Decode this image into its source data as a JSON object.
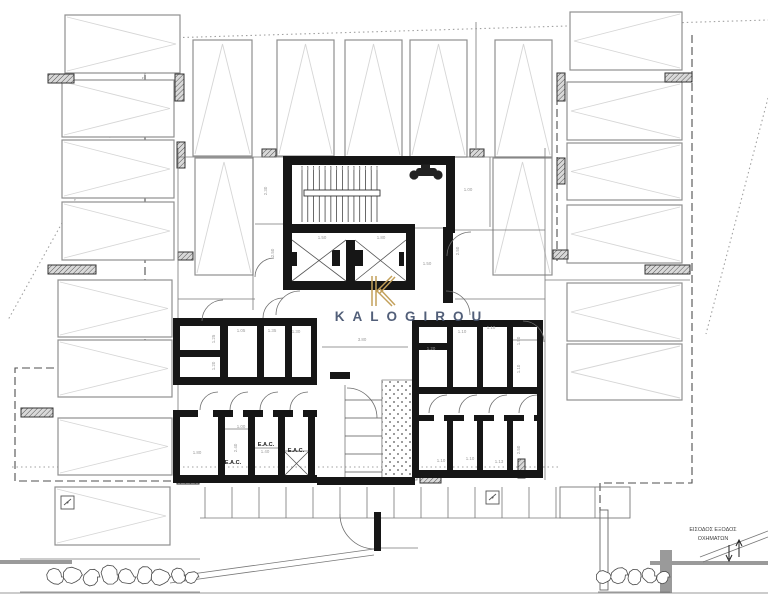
{
  "watermark": {
    "logo": "K",
    "brand": "KALOGIROU",
    "gold": "#c3a05a",
    "navy": "#44526e"
  },
  "entrance_note": {
    "line1": "ΕΙΣΟΔΟΣ ΕΞΟΔΟΣ",
    "line2": "ΟΧΗΜΑΤΩΝ"
  },
  "eac_labels": [
    {
      "text": "E.A.C.",
      "x": 266,
      "y": 446
    },
    {
      "text": "E.A.C.",
      "x": 296,
      "y": 452
    },
    {
      "text": "E.A.C.",
      "x": 233,
      "y": 464
    }
  ],
  "dimensions": [
    {
      "t": "3.80",
      "x": 362,
      "y": 341,
      "r": 0
    },
    {
      "t": "1.25",
      "x": 215,
      "y": 339,
      "r": -90
    },
    {
      "t": "1.05",
      "x": 241,
      "y": 332,
      "r": 0
    },
    {
      "t": "1.35",
      "x": 272,
      "y": 332,
      "r": 0
    },
    {
      "t": "1.30",
      "x": 296,
      "y": 333,
      "r": 0
    },
    {
      "t": "1.20",
      "x": 215,
      "y": 366,
      "r": -90
    },
    {
      "t": "1.00",
      "x": 241,
      "y": 428,
      "r": 0
    },
    {
      "t": "2.40",
      "x": 237,
      "y": 448,
      "r": -90
    },
    {
      "t": "1.80",
      "x": 197,
      "y": 454,
      "r": 0
    },
    {
      "t": "1.40",
      "x": 265,
      "y": 453,
      "r": 0
    },
    {
      "t": "1.20",
      "x": 431,
      "y": 350,
      "r": 0
    },
    {
      "t": "1.10",
      "x": 462,
      "y": 333,
      "r": 0
    },
    {
      "t": "1.10",
      "x": 491,
      "y": 329,
      "r": 0
    },
    {
      "t": "1.50",
      "x": 520,
      "y": 341,
      "r": -90
    },
    {
      "t": "1.10",
      "x": 520,
      "y": 369,
      "r": -90
    },
    {
      "t": "1.10",
      "x": 441,
      "y": 462,
      "r": 0
    },
    {
      "t": "1.10",
      "x": 470,
      "y": 460,
      "r": 0
    },
    {
      "t": "1.13",
      "x": 499,
      "y": 463,
      "r": 0
    },
    {
      "t": "2.50",
      "x": 520,
      "y": 450,
      "r": -90
    },
    {
      "t": "1.50",
      "x": 322,
      "y": 239,
      "r": 0
    },
    {
      "t": "1.80",
      "x": 381,
      "y": 239,
      "r": 0
    },
    {
      "t": "2.30",
      "x": 267,
      "y": 191,
      "r": -90
    },
    {
      "t": "2.50",
      "x": 274,
      "y": 253,
      "r": -90
    },
    {
      "t": "1.50",
      "x": 427,
      "y": 265,
      "r": 0
    },
    {
      "t": "1.00",
      "x": 468,
      "y": 191,
      "r": 0
    },
    {
      "t": "2.50",
      "x": 459,
      "y": 251,
      "r": -90
    }
  ],
  "colors": {
    "wall": "#161616",
    "stall": "#8f8f8f",
    "chevron": "#d6d6d6",
    "thin": "#787878",
    "dim_text": "#9a9a9a",
    "label_text": "#1a1a1a",
    "dashed": "#4f4f4f",
    "dotted": "#a0a0a0",
    "site": "#8a8a8a",
    "bush": "#4c4c4c"
  },
  "plan": {
    "stalls": [
      {
        "x": 193,
        "y": 40,
        "w": 59,
        "h": 116,
        "dir": "up"
      },
      {
        "x": 277,
        "y": 40,
        "w": 57,
        "h": 116,
        "dir": "up"
      },
      {
        "x": 345,
        "y": 40,
        "w": 57,
        "h": 117,
        "dir": "up"
      },
      {
        "x": 410,
        "y": 40,
        "w": 57,
        "h": 117,
        "dir": "up"
      },
      {
        "x": 495,
        "y": 40,
        "w": 57,
        "h": 117,
        "dir": "up"
      },
      {
        "x": 195,
        "y": 158,
        "w": 58,
        "h": 117,
        "dir": "up"
      },
      {
        "x": 493,
        "y": 158,
        "w": 59,
        "h": 117,
        "dir": "up"
      },
      {
        "x": 65,
        "y": 15,
        "w": 115,
        "h": 58,
        "dir": "right"
      },
      {
        "x": 62,
        "y": 80,
        "w": 112,
        "h": 57,
        "dir": "right"
      },
      {
        "x": 62,
        "y": 140,
        "w": 112,
        "h": 58,
        "dir": "right"
      },
      {
        "x": 62,
        "y": 202,
        "w": 112,
        "h": 58,
        "dir": "right"
      },
      {
        "x": 58,
        "y": 280,
        "w": 114,
        "h": 57,
        "dir": "right"
      },
      {
        "x": 58,
        "y": 340,
        "w": 114,
        "h": 57,
        "dir": "right"
      },
      {
        "x": 58,
        "y": 418,
        "w": 114,
        "h": 57,
        "dir": "right"
      },
      {
        "x": 55,
        "y": 487,
        "w": 115,
        "h": 58,
        "dir": "right"
      },
      {
        "x": 570,
        "y": 12,
        "w": 112,
        "h": 58,
        "dir": "left"
      },
      {
        "x": 567,
        "y": 82,
        "w": 115,
        "h": 58,
        "dir": "left"
      },
      {
        "x": 567,
        "y": 143,
        "w": 115,
        "h": 57,
        "dir": "left"
      },
      {
        "x": 567,
        "y": 205,
        "w": 115,
        "h": 58,
        "dir": "left"
      },
      {
        "x": 567,
        "y": 283,
        "w": 115,
        "h": 58,
        "dir": "left"
      },
      {
        "x": 567,
        "y": 344,
        "w": 115,
        "h": 56,
        "dir": "left"
      }
    ],
    "columns": [
      [
        48,
        74,
        26,
        9
      ],
      [
        175,
        74,
        9,
        27
      ],
      [
        177,
        142,
        8,
        26
      ],
      [
        48,
        265,
        48,
        9
      ],
      [
        178,
        252,
        15,
        8
      ],
      [
        21,
        408,
        32,
        9
      ],
      [
        177,
        477,
        22,
        7
      ],
      [
        557,
        73,
        8,
        28
      ],
      [
        665,
        73,
        27,
        9
      ],
      [
        557,
        158,
        8,
        26
      ],
      [
        645,
        265,
        45,
        9
      ],
      [
        553,
        250,
        15,
        9
      ],
      [
        518,
        459,
        7,
        19
      ],
      [
        420,
        477,
        21,
        6
      ],
      [
        262,
        149,
        14,
        8
      ],
      [
        470,
        149,
        14,
        8
      ]
    ],
    "walls": [
      [
        283,
        156,
        172,
        9
      ],
      [
        283,
        156,
        9,
        77
      ],
      [
        446,
        156,
        9,
        77
      ],
      [
        283,
        224,
        132,
        9
      ],
      [
        283,
        233,
        9,
        57
      ],
      [
        346,
        240,
        9,
        41
      ],
      [
        406,
        233,
        9,
        57
      ],
      [
        283,
        281,
        132,
        9
      ],
      [
        292,
        252,
        5,
        14
      ],
      [
        332,
        250,
        8,
        16
      ],
      [
        355,
        250,
        8,
        16
      ],
      [
        399,
        252,
        5,
        14
      ],
      [
        443,
        227,
        10,
        76
      ],
      [
        173,
        318,
        144,
        8
      ],
      [
        173,
        318,
        7,
        67
      ],
      [
        220,
        318,
        8,
        67
      ],
      [
        173,
        350,
        55,
        7
      ],
      [
        173,
        377,
        55,
        8
      ],
      [
        257,
        318,
        7,
        62
      ],
      [
        285,
        318,
        7,
        62
      ],
      [
        311,
        318,
        6,
        67
      ],
      [
        220,
        377,
        97,
        8
      ],
      [
        173,
        410,
        25,
        7
      ],
      [
        213,
        410,
        20,
        7
      ],
      [
        243,
        410,
        20,
        7
      ],
      [
        273,
        410,
        20,
        7
      ],
      [
        303,
        410,
        14,
        7
      ],
      [
        173,
        410,
        7,
        73
      ],
      [
        218,
        410,
        7,
        70
      ],
      [
        248,
        410,
        7,
        70
      ],
      [
        278,
        410,
        7,
        70
      ],
      [
        308,
        410,
        7,
        70
      ],
      [
        173,
        475,
        144,
        8
      ],
      [
        412,
        320,
        131,
        7
      ],
      [
        412,
        343,
        35,
        7
      ],
      [
        412,
        320,
        7,
        67
      ],
      [
        447,
        327,
        6,
        62
      ],
      [
        477,
        327,
        6,
        62
      ],
      [
        507,
        327,
        6,
        62
      ],
      [
        412,
        387,
        131,
        7
      ],
      [
        537,
        320,
        6,
        158
      ],
      [
        412,
        415,
        22,
        6
      ],
      [
        444,
        415,
        20,
        6
      ],
      [
        474,
        415,
        20,
        6
      ],
      [
        504,
        415,
        20,
        6
      ],
      [
        534,
        415,
        9,
        6
      ],
      [
        447,
        415,
        6,
        60
      ],
      [
        477,
        415,
        6,
        60
      ],
      [
        507,
        415,
        6,
        60
      ],
      [
        412,
        387,
        7,
        91
      ],
      [
        412,
        470,
        131,
        8
      ],
      [
        330,
        372,
        20,
        7
      ],
      [
        317,
        477,
        98,
        8
      ],
      [
        374,
        512,
        7,
        39
      ]
    ],
    "thin_lines": [
      [
        178,
        148,
        178,
        480
      ],
      [
        545,
        148,
        545,
        480
      ],
      [
        178,
        157,
        283,
        157
      ],
      [
        455,
        157,
        545,
        157
      ],
      [
        253,
        157,
        253,
        310
      ],
      [
        255,
        224,
        283,
        224
      ],
      [
        178,
        299,
        255,
        299
      ],
      [
        455,
        230,
        545,
        230
      ],
      [
        490,
        157,
        490,
        227
      ],
      [
        455,
        299,
        545,
        299
      ],
      [
        476,
        22,
        476,
        148
      ],
      [
        545,
        280,
        690,
        280
      ],
      [
        322,
        347,
        408,
        347
      ],
      [
        200,
        518,
        560,
        518
      ],
      [
        381,
        548,
        418,
        548
      ],
      [
        415,
        228,
        455,
        228
      ],
      [
        20,
        559,
        200,
        559
      ],
      [
        20,
        592,
        200,
        592
      ],
      [
        598,
        592,
        670,
        592
      ],
      [
        170,
        577,
        374,
        549
      ],
      [
        170,
        583,
        374,
        555
      ],
      [
        768,
        531,
        700,
        557
      ],
      [
        768,
        537,
        703,
        562
      ],
      [
        225,
        429,
        248,
        429
      ],
      [
        255,
        448,
        278,
        448
      ],
      [
        285,
        451,
        308,
        451
      ],
      [
        510,
        340,
        537,
        340
      ],
      [
        345,
        385,
        345,
        485
      ],
      [
        382,
        380,
        382,
        480
      ],
      [
        595,
        487,
        595,
        518
      ],
      [
        0,
        593,
        768,
        593
      ]
    ],
    "xlines": [
      [
        292,
        240,
        346,
        281
      ],
      [
        346,
        240,
        292,
        281
      ],
      [
        355,
        240,
        406,
        281
      ],
      [
        406,
        240,
        355,
        281
      ],
      [
        285,
        452,
        308,
        475
      ],
      [
        308,
        452,
        285,
        475
      ]
    ],
    "arcs": [
      "M276,315 A24,24 0 0 1 300,291",
      "M470,315 A24,24 0 0 0 446,291",
      "M544,342 A21,21 0 0 0 523,321",
      "M471,232 A24,24 0 0 0 447,256",
      "M255,277 A19,19 0 0 1 274,258",
      "M202,321 A21,21 0 0 1 223,300",
      "M263,318 A20,20 0 0 1 283,298",
      "M218,392 A18,18 0 0 0 200,410",
      "M248,392 A18,18 0 0 0 230,410",
      "M278,392 A18,18 0 0 0 260,410",
      "M308,392 A18,18 0 0 0 290,410",
      "M447,395 A18,18 0 0 0 429,413",
      "M477,395 A18,18 0 0 0 459,413",
      "M507,395 A18,18 0 0 0 489,413",
      "M537,395 A18,18 0 0 0 519,413",
      "M340,514 A35,35 0 0 0 374,549",
      "M347,388 A30,30 0 0 1 377,418"
    ],
    "dashed": [
      "M145,75 V368 H15 V481 H190",
      "M557,73 V262",
      "M692,35 V483 H600 V513"
    ],
    "dotted": [
      "M165,38 L768,20",
      "M165,38 L8,320",
      "M768,98 L706,334",
      "M12,467 H560"
    ],
    "strip": {
      "x1": 205,
      "x2": 557,
      "step": 27,
      "y1": 487,
      "y2": 518
    },
    "gate_rect": [
      560,
      487,
      70,
      31
    ],
    "site_wall_rect": [
      600,
      510,
      8,
      80
    ],
    "site_bars": [
      [
        0,
        560,
        72,
        4
      ],
      [
        650,
        561,
        118,
        4
      ],
      [
        660,
        550,
        12,
        43
      ]
    ],
    "stipple_rect": [
      382,
      380,
      35,
      100
    ],
    "handrail_rect": [
      304,
      190,
      76,
      6
    ],
    "stair_treads": {
      "x1": 302,
      "x2": 377,
      "n": 14,
      "y1": 166,
      "y2": 222
    },
    "mid_treads": {
      "x1": 345,
      "x2": 382,
      "ys": [
        400,
        418,
        436,
        454,
        472
      ]
    },
    "bushes": [
      [
        55,
        577,
        9
      ],
      [
        73,
        575,
        10
      ],
      [
        91,
        577,
        9
      ],
      [
        109,
        575,
        10
      ],
      [
        127,
        577,
        9
      ],
      [
        144,
        575,
        9
      ],
      [
        161,
        577,
        10
      ],
      [
        178,
        576,
        8
      ],
      [
        192,
        577,
        7
      ],
      [
        604,
        577,
        8
      ],
      [
        619,
        575,
        9
      ],
      [
        634,
        577,
        8
      ],
      [
        649,
        576,
        8
      ],
      [
        663,
        577,
        7
      ]
    ],
    "symbols": [
      [
        61,
        496
      ],
      [
        486,
        491
      ]
    ],
    "logo_lines": [
      [
        372,
        276,
        372,
        306
      ],
      [
        376,
        276,
        376,
        306
      ],
      [
        376,
        292,
        392,
        276
      ],
      [
        380,
        293,
        395,
        277
      ],
      [
        376,
        290,
        392,
        306
      ],
      [
        380,
        289,
        395,
        305
      ]
    ]
  }
}
